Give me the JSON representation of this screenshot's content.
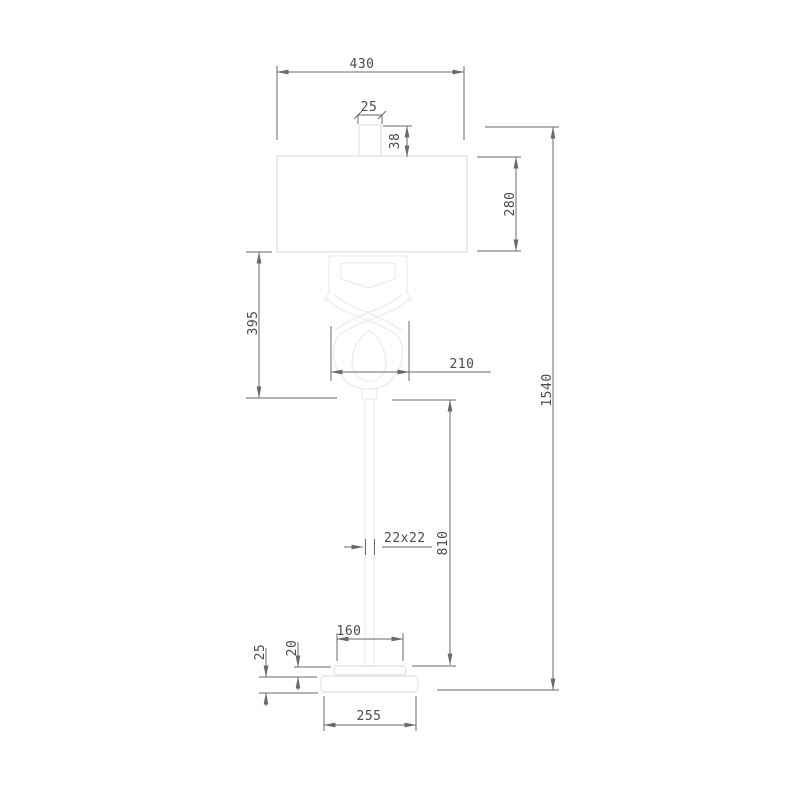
{
  "drawing": {
    "object": "floor-lamp-technical-drawing",
    "dimensions": {
      "shade_width": "430",
      "finial_width": "25",
      "finial_height": "38",
      "shade_height": "280",
      "upper_section_height": "395",
      "decor_width": "210",
      "total_height": "1540",
      "pole_section": "22x22",
      "pole_height": "810",
      "upper_base_width": "160",
      "upper_base_height": "20",
      "base_height": "25",
      "base_width": "255"
    },
    "colors": {
      "background": "#ffffff",
      "outline": "#e5e5e5",
      "dimension_lines": "#6a6a6a",
      "dimension_text": "#4b4b4b"
    }
  }
}
